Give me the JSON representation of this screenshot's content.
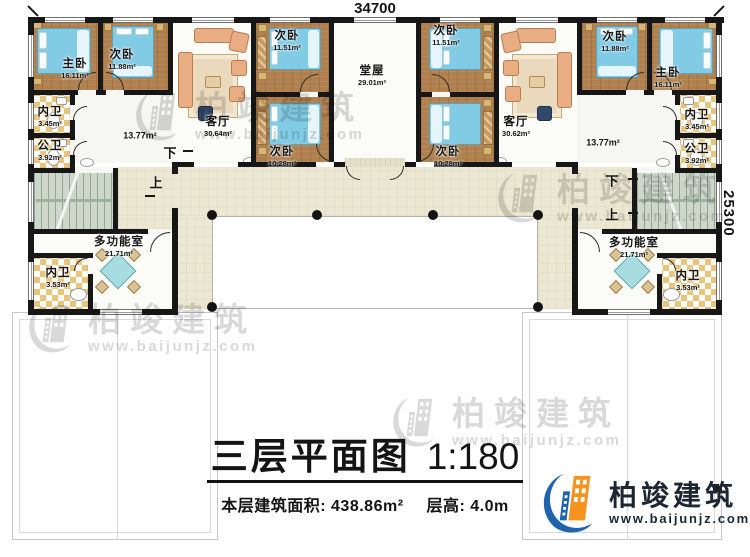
{
  "plan": {
    "dim_top": "34700",
    "dim_right": "25300",
    "stair_up": "上",
    "stair_down": "下",
    "rooms": [
      {
        "name": "主卧",
        "area": "16.11m²"
      },
      {
        "name": "次卧",
        "area": "11.88m²"
      },
      {
        "name": "内卫",
        "area": "3.45m²"
      },
      {
        "name": "公卫",
        "area": "3.92m²"
      },
      {
        "name": "",
        "area": "13.77m²"
      },
      {
        "name": "客厅",
        "area": "30.64m²"
      },
      {
        "name": "次卧",
        "area": "11.51m²"
      },
      {
        "name": "次卧",
        "area": "10.28m²"
      },
      {
        "name": "堂屋",
        "area": "29.01m²"
      },
      {
        "name": "次卧",
        "area": "11.51m²"
      },
      {
        "name": "次卧",
        "area": "10.28m²"
      },
      {
        "name": "客厅",
        "area": "30.62m²"
      },
      {
        "name": "次卧",
        "area": "11.88m²"
      },
      {
        "name": "主卧",
        "area": "16.11m²"
      },
      {
        "name": "内卫",
        "area": "3.45m²"
      },
      {
        "name": "公卫",
        "area": "3.92m²"
      },
      {
        "name": "",
        "area": "13.77m²"
      },
      {
        "name": "多功能室",
        "area": "21.71m²"
      },
      {
        "name": "内卫",
        "area": "3.53m²"
      },
      {
        "name": "多功能室",
        "area": "21.71m²"
      },
      {
        "name": "内卫",
        "area": "3.53m²"
      }
    ]
  },
  "title_block": {
    "title": "三层平面图",
    "scale": "1:180",
    "area_label": "本层建筑面积:",
    "area_value": "438.86m²",
    "height_label": "层高:",
    "height_value": "4.0m"
  },
  "watermark": {
    "brand": "柏竣建筑",
    "url": "www.baijunjz.com"
  },
  "logo": {
    "brand": "柏竣建筑",
    "url": "www.baijunjz.com"
  },
  "colors": {
    "logo_blue": "#1f63ad",
    "logo_orange": "#f6921e",
    "watermark_gray": "#d9d9d9",
    "wall": "#171717",
    "bedroom_floor": "#b0804e",
    "deck": "#ebe7d1",
    "bed": "#82cbe5"
  }
}
